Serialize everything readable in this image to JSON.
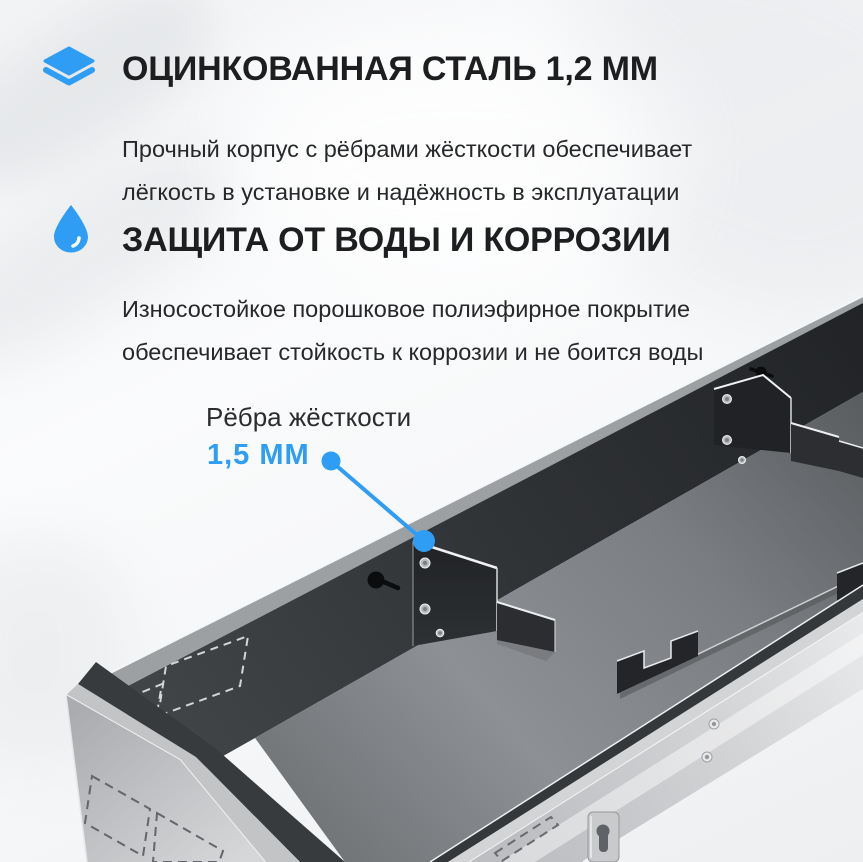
{
  "colors": {
    "accent_blue": "#2f9df3",
    "heading_text": "#1d1e20",
    "body_text": "#26282a",
    "tray_dark_wall": "#34373a",
    "tray_floor": "#7c7f83",
    "tray_light_wall": "#c8cacc"
  },
  "features": [
    {
      "icon": "layers-icon",
      "title": "ОЦИНКОВАННАЯ СТАЛЬ 1,2 ММ",
      "description_lines": [
        "Прочный корпус с рёбрами жёсткости обеспечивает",
        "лёгкость в установке и надёжность в эксплуатации"
      ]
    },
    {
      "icon": "water-drop-icon",
      "title": "ЗАЩИТА ОТ ВОДЫ И КОРРОЗИИ",
      "description_lines": [
        "Износостойкое порошковое полиэфирное покрытие",
        "обеспечивает стойкость к коррозии и не боится воды"
      ]
    }
  ],
  "callout": {
    "label": "Рёбра жёсткости",
    "value": "1,5 ММ"
  }
}
